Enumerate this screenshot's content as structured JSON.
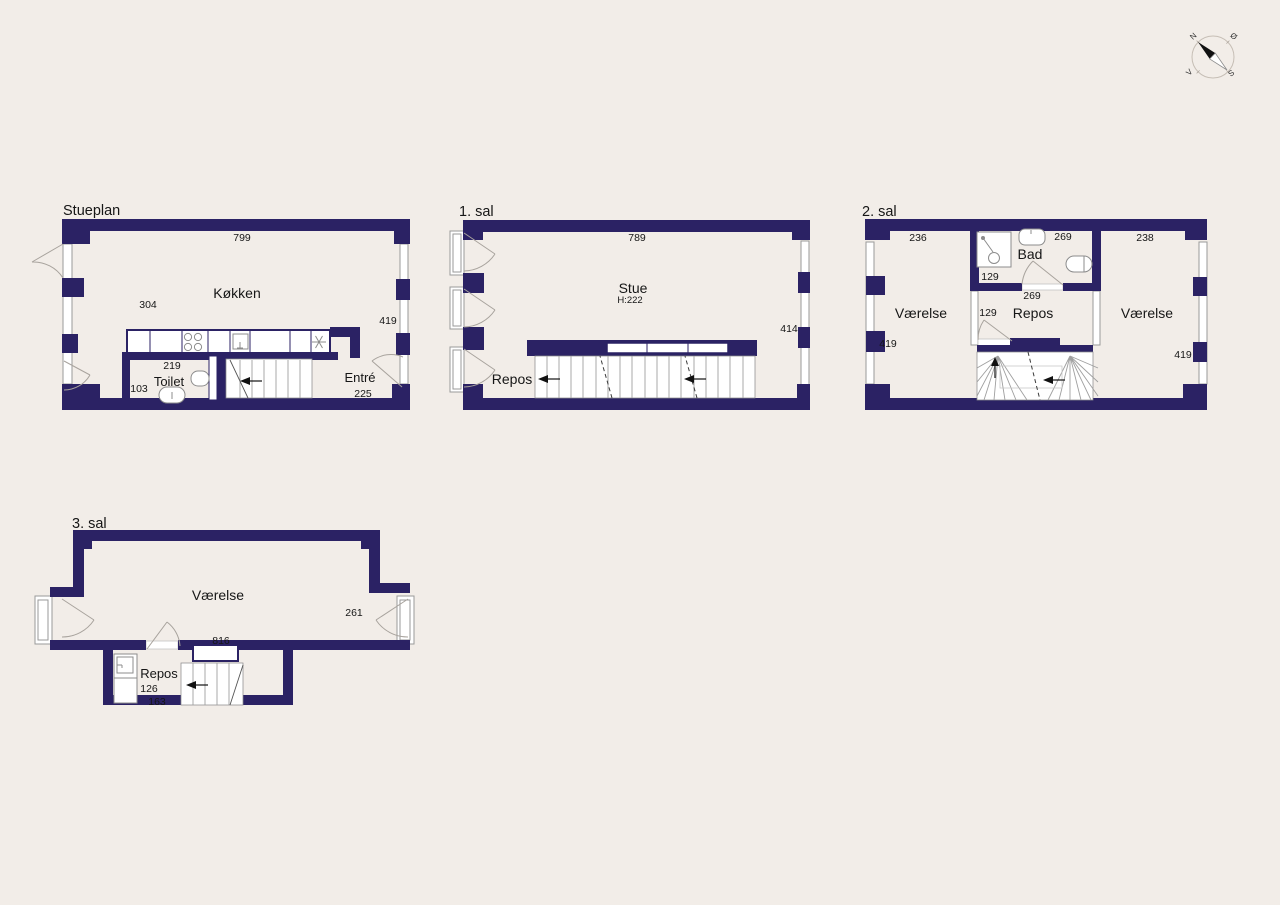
{
  "colors": {
    "background": "#f2ede8",
    "wall": "#2b2264"
  },
  "compass": {
    "north": "N",
    "east": "Ø",
    "south": "S",
    "west": "V"
  },
  "floors": {
    "ground": {
      "title": "Stueplan",
      "rooms": {
        "kitchen": "Køkken",
        "toilet": "Toilet",
        "entry": "Entré"
      },
      "dims": {
        "top_width": "799",
        "kitchen_depth": "304",
        "right_depth": "419",
        "toilet_width": "219",
        "toilet_depth": "103",
        "entry_width": "225"
      }
    },
    "first": {
      "title": "1. sal",
      "rooms": {
        "living": "Stue",
        "living_height": "H:222",
        "repos": "Repos"
      },
      "dims": {
        "top_width": "789",
        "right_depth": "414"
      }
    },
    "second": {
      "title": "2. sal",
      "rooms": {
        "left_room": "Værelse",
        "bath": "Bad",
        "repos": "Repos",
        "right_room": "Værelse"
      },
      "dims": {
        "left_room_width": "236",
        "left_depth": "419",
        "bath_width": "269",
        "bath_depth": "129",
        "repos_width": "269",
        "repos_door_width": "129",
        "right_room_width": "238",
        "right_depth": "419"
      }
    },
    "third": {
      "title": "3. sal",
      "rooms": {
        "room": "Værelse",
        "repos": "Repos"
      },
      "dims": {
        "room_width": "816",
        "right_depth": "261",
        "repos_width": "126",
        "repos_depth": "163"
      }
    }
  }
}
